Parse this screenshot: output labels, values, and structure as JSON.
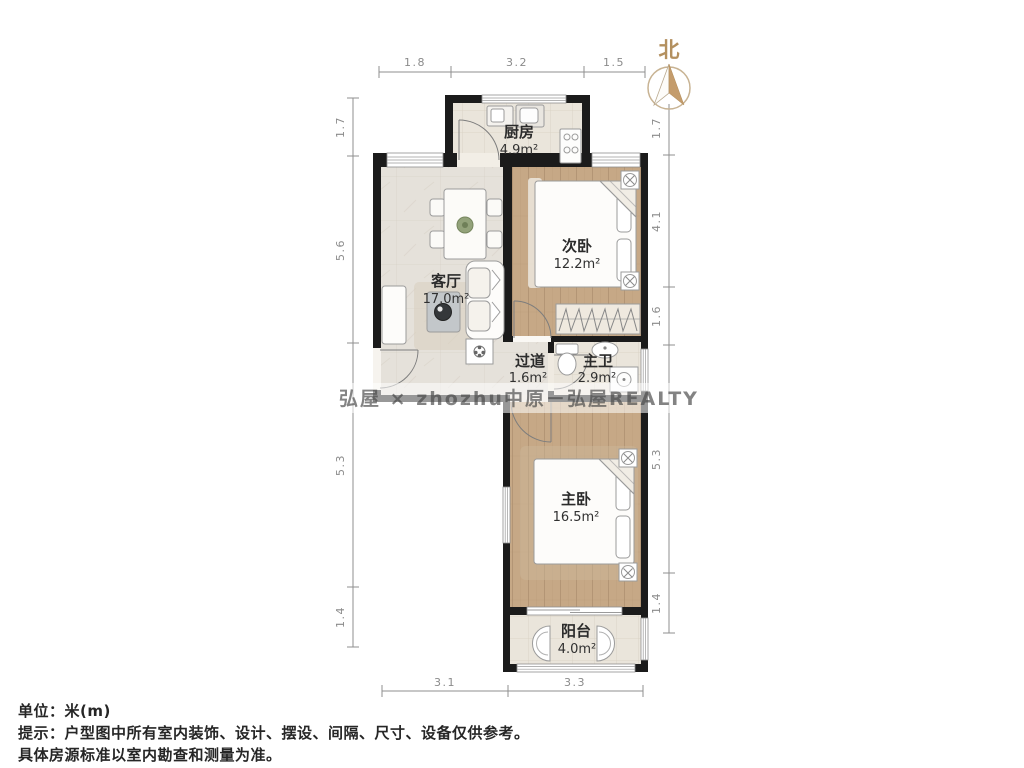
{
  "title": "户型图",
  "north": {
    "label": "北"
  },
  "rooms": [
    {
      "id": "kitchen",
      "name": "厨房",
      "area": "4.9m²"
    },
    {
      "id": "living",
      "name": "客厅",
      "area": "17.0m²"
    },
    {
      "id": "bedroom2",
      "name": "次卧",
      "area": "12.2m²"
    },
    {
      "id": "hallway",
      "name": "过道",
      "area": "1.6m²"
    },
    {
      "id": "bathroom",
      "name": "主卫",
      "area": "2.9m²"
    },
    {
      "id": "bedroom1",
      "name": "主卧",
      "area": "16.5m²"
    },
    {
      "id": "balcony",
      "name": "阳台",
      "area": "4.0m²"
    }
  ],
  "dimensions": {
    "unit": "米(m)",
    "top": [
      "1.8",
      "3.2",
      "1.5"
    ],
    "left": [
      "1.7",
      "5.6",
      "5.3",
      "1.4"
    ],
    "right": [
      "1.7",
      "4.1",
      "1.6",
      "5.3",
      "1.4"
    ],
    "bottom": [
      "3.1",
      "3.3"
    ]
  },
  "watermark": {
    "text": "弘屋 × zhozhu中原－弘屋REALTY"
  },
  "footer": {
    "unit_line": "单位：米(m)",
    "note_line1": "提示：户型图中所有室内装饰、设计、摆设、间隔、尺寸、设备仅供参考。",
    "note_line2": "具体房源标准以室内勘查和测量为准。"
  },
  "colors": {
    "wall": "#1b1b1b",
    "wood_floor": "#c6a886",
    "tile_floor": "#eae5db",
    "marble_floor": "#e5e1da",
    "dimension_line": "#8f8f8f",
    "north_accent": "#b3905f",
    "compass_arrow": "#c49c6c"
  }
}
